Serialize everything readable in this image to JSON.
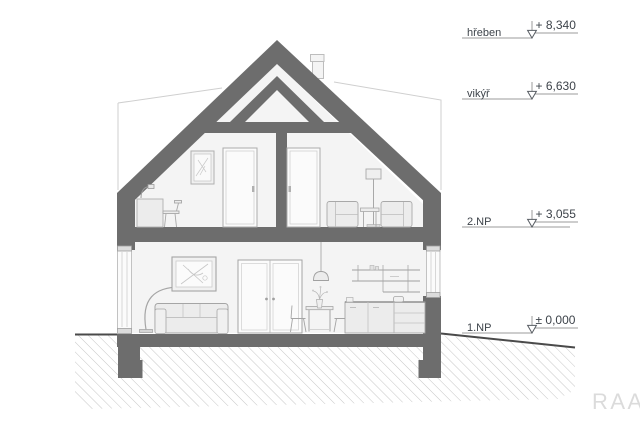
{
  "drawing": {
    "elevation_markers": [
      {
        "label": "hřeben",
        "value": "+ 8,340"
      },
      {
        "label": "vikýř",
        "value": "+ 6,630"
      },
      {
        "label": "2.NP",
        "value": "+ 3,055"
      },
      {
        "label": "1.NP",
        "value": "± 0,000"
      }
    ],
    "watermark": "RAA",
    "colors": {
      "structure": "#6d6d6d",
      "room_fill": "#f4f4f4",
      "annotation": "#3d434a",
      "hatch": "#c6c6c6",
      "watermark": "#dbdbdb"
    }
  }
}
